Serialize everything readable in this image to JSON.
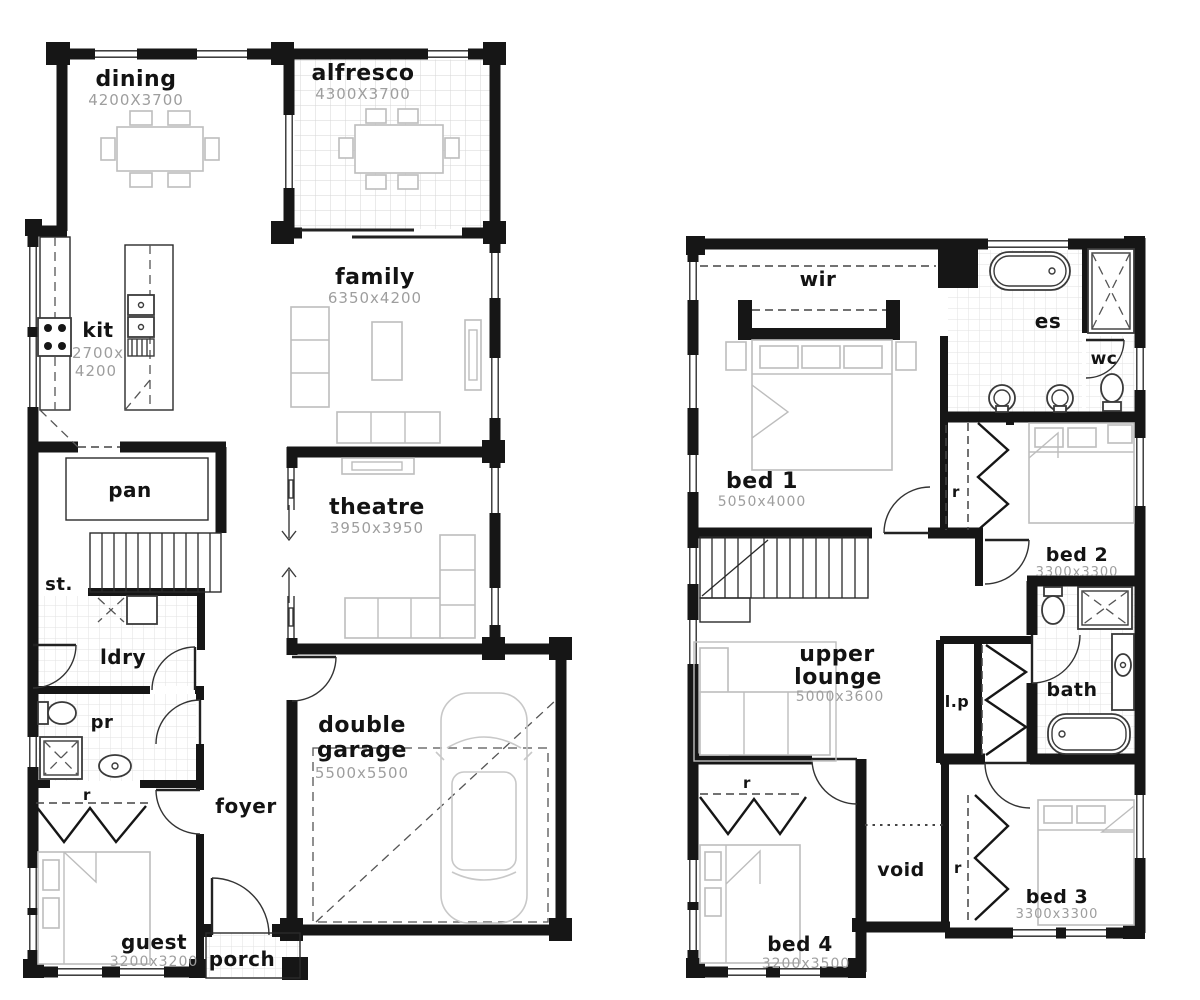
{
  "colors": {
    "wall": "#161616",
    "label_text": "#131313",
    "dim_text": "#9e9e9e",
    "furniture": "#bdbdbd",
    "fixture": "#3a3a3a",
    "tile_line": "#dedede"
  },
  "ground_floor": {
    "dining": {
      "label": "dining",
      "dims": "4200X3700"
    },
    "alfresco": {
      "label": "alfresco",
      "dims": "4300X3700"
    },
    "family": {
      "label": "family",
      "dims": "6350x4200"
    },
    "kit": {
      "label": "kit",
      "dims_line1": "2700x",
      "dims_line2": "4200"
    },
    "pan": {
      "label": "pan"
    },
    "st": {
      "label": "st."
    },
    "ldry": {
      "label": "ldry"
    },
    "pr": {
      "label": "pr"
    },
    "robe_guest": {
      "label": "r"
    },
    "theatre": {
      "label": "theatre",
      "dims": "3950x3950"
    },
    "garage": {
      "label_line1": "double",
      "label_line2": "garage",
      "dims": "5500x5500"
    },
    "foyer": {
      "label": "foyer"
    },
    "guest": {
      "label": "guest",
      "dims": "3200x3200"
    },
    "porch": {
      "label": "porch"
    }
  },
  "upper_floor": {
    "wir": {
      "label": "wir"
    },
    "es": {
      "label": "es"
    },
    "wc": {
      "label": "wc"
    },
    "bed1": {
      "label": "bed 1",
      "dims": "5050x4000"
    },
    "robe_bed1": {
      "label": "r"
    },
    "bed2": {
      "label": "bed 2",
      "dims": "3300x3300"
    },
    "lounge": {
      "label_line1": "upper",
      "label_line2": "lounge",
      "dims": "5000x3600"
    },
    "lp": {
      "label": "l.p"
    },
    "bath": {
      "label": "bath"
    },
    "robe_bed4": {
      "label": "r"
    },
    "void": {
      "label": "void"
    },
    "robe_bed3": {
      "label": "r"
    },
    "bed3": {
      "label": "bed 3",
      "dims": "3300x3300"
    },
    "bed4": {
      "label": "bed 4",
      "dims": "3200x3500"
    }
  }
}
